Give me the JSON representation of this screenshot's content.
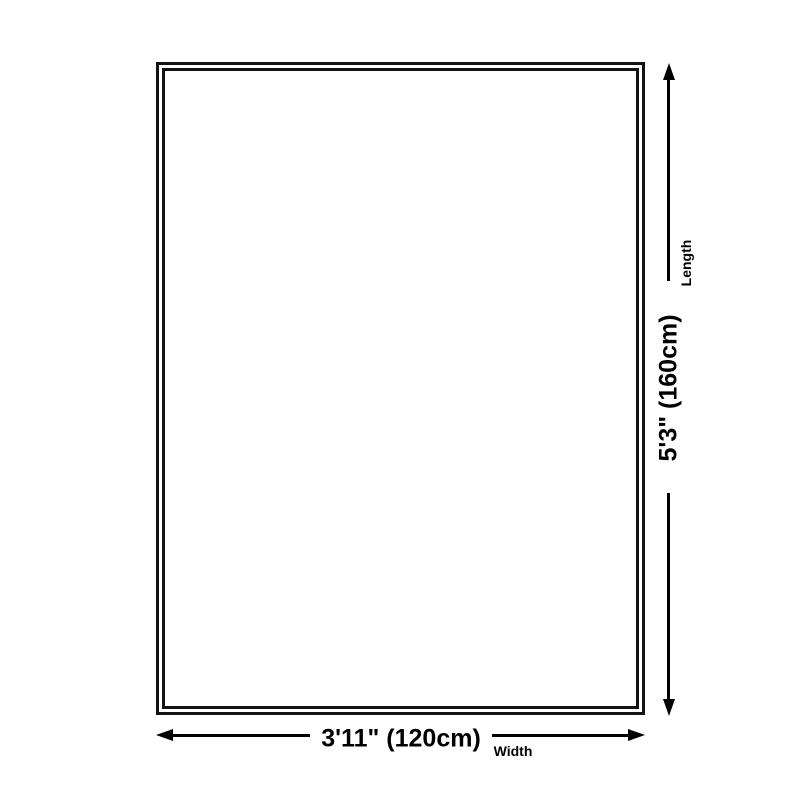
{
  "diagram": {
    "type": "product-dimension-diagram",
    "shape": "rectangle-double-border",
    "width": {
      "value_label": "3'11\" (120cm)",
      "axis_label": "Width",
      "feet_inches": "3'11\"",
      "centimeters": 120
    },
    "length": {
      "value_label": "5'3\" (160cm)",
      "axis_label": "Length",
      "feet_inches": "5'3\"",
      "centimeters": 160
    },
    "colors": {
      "background": "#ffffff",
      "outline_border": "#131313",
      "arrow_and_text": "#000000"
    }
  }
}
